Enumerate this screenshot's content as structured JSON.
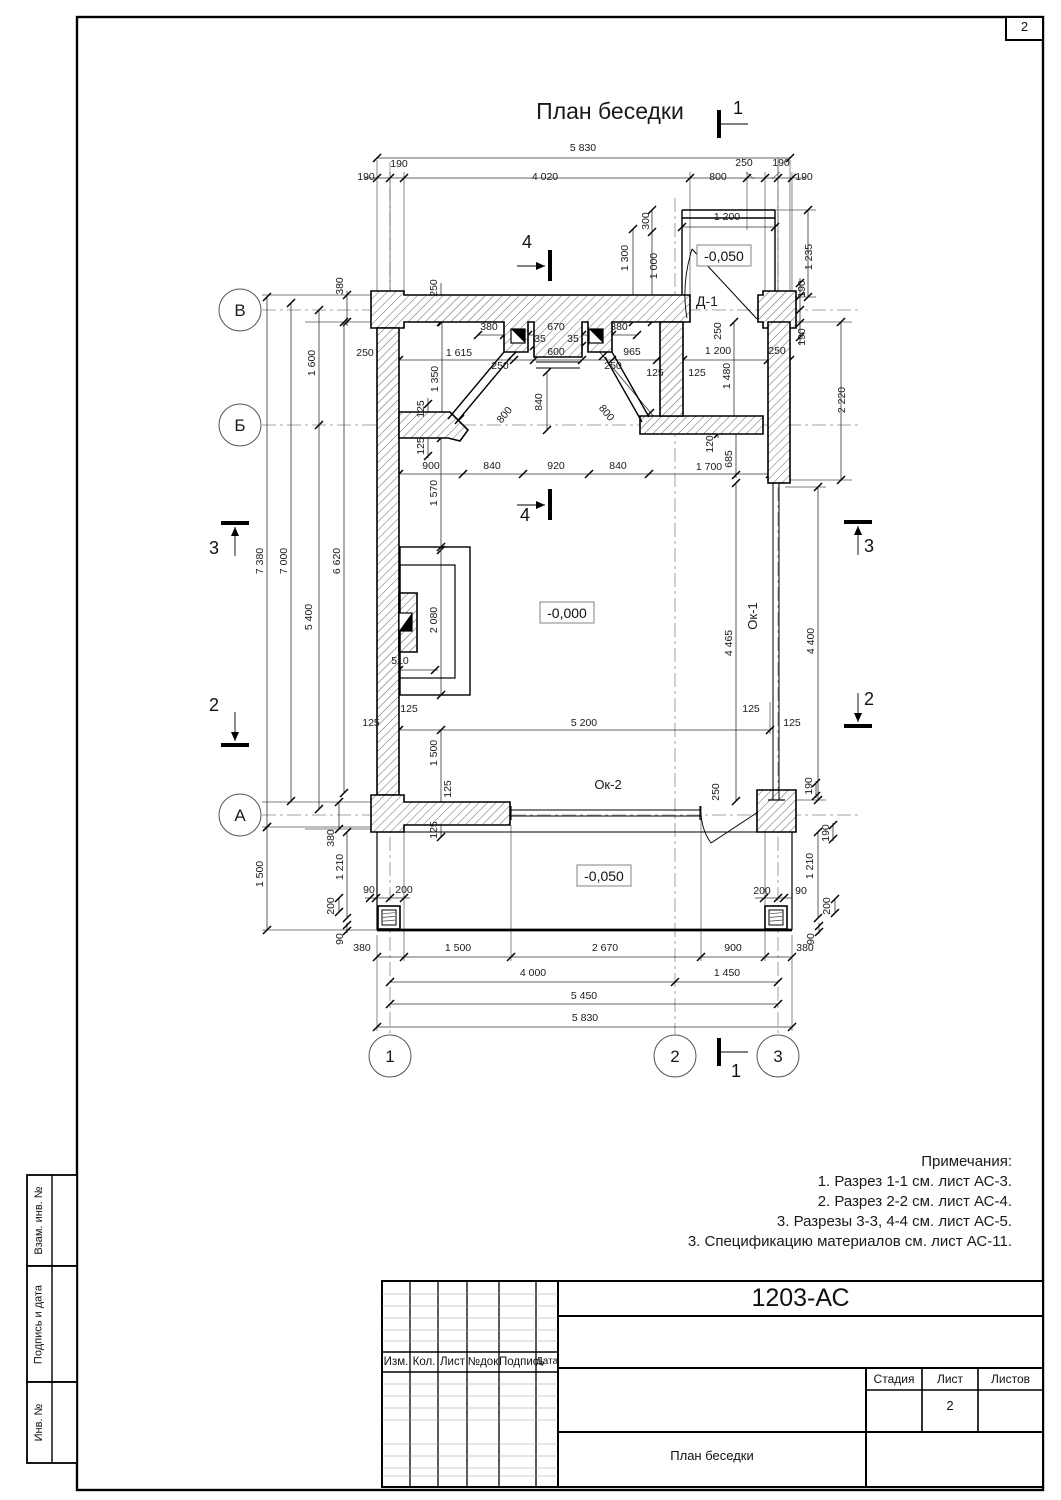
{
  "page": {
    "number": "2"
  },
  "title": "План беседки",
  "side_stamps": [
    "Взам. инв. №",
    "Подпись и дата",
    "Инв. №"
  ],
  "notes": {
    "heading": "Примечания:",
    "items": [
      "1. Разрез 1-1 см. лист АС-3.",
      "2. Разрез 2-2 см. лист АС-4.",
      "3. Разрезы 3-3, 4-4 см. лист АС-5.",
      "3. Спецификацию материалов см. лист АС-11."
    ]
  },
  "title_block": {
    "doc_number": "1203-АС",
    "columns": [
      "Изм.",
      "Кол.",
      "Лист",
      "№док",
      "Подпись",
      "Дата"
    ],
    "stage_label": "Стадия",
    "sheet_label": "Лист",
    "sheets_label": "Листов",
    "sheet_value": "2",
    "drawing_name": "План беседки"
  },
  "axis_markers": [
    {
      "t": "В",
      "x": 240,
      "y": 310
    },
    {
      "t": "Б",
      "x": 240,
      "y": 425
    },
    {
      "t": "А",
      "x": 240,
      "y": 815
    },
    {
      "t": "1",
      "x": 390,
      "y": 1056
    },
    {
      "t": "2",
      "x": 675,
      "y": 1056
    },
    {
      "t": "3",
      "x": 778,
      "y": 1056
    }
  ],
  "section_labels": [
    {
      "t": "1",
      "x": 738,
      "y": 114
    },
    {
      "t": "1",
      "x": 736,
      "y": 1077
    },
    {
      "t": "4",
      "x": 527,
      "y": 248
    },
    {
      "t": "4",
      "x": 525,
      "y": 521
    },
    {
      "t": "3",
      "x": 214,
      "y": 554
    },
    {
      "t": "2",
      "x": 214,
      "y": 711
    },
    {
      "t": "3",
      "x": 869,
      "y": 552
    },
    {
      "t": "2",
      "x": 869,
      "y": 705
    }
  ],
  "elevations": [
    {
      "t": "-0,050",
      "x": 724,
      "y": 257
    },
    {
      "t": "-0,000",
      "x": 567,
      "y": 614
    },
    {
      "t": "-0,050",
      "x": 604,
      "y": 877
    }
  ],
  "dims": [
    {
      "t": "5 830",
      "x": 583,
      "y": 151
    },
    {
      "t": "190",
      "x": 399,
      "y": 167
    },
    {
      "t": "190",
      "x": 366,
      "y": 180
    },
    {
      "t": "4 020",
      "x": 545,
      "y": 180
    },
    {
      "t": "800",
      "x": 718,
      "y": 180
    },
    {
      "t": "250",
      "x": 744,
      "y": 166
    },
    {
      "t": "190",
      "x": 781,
      "y": 166
    },
    {
      "t": "190",
      "x": 804,
      "y": 180
    },
    {
      "t": "1 200",
      "x": 727,
      "y": 220
    },
    {
      "t": "300",
      "x": 649,
      "y": 221,
      "r": -90
    },
    {
      "t": "1 300",
      "x": 628,
      "y": 258,
      "r": -90
    },
    {
      "t": "1 000",
      "x": 657,
      "y": 266,
      "r": -90
    },
    {
      "t": "1 235",
      "x": 812,
      "y": 257,
      "r": -90
    },
    {
      "t": "190",
      "x": 805,
      "y": 289,
      "r": -90
    },
    {
      "t": "190",
      "x": 805,
      "y": 337,
      "r": -90
    },
    {
      "t": "Д-1",
      "x": 707,
      "y": 306,
      "s": 14
    },
    {
      "t": "250",
      "x": 721,
      "y": 331,
      "r": -90
    },
    {
      "t": "1 200",
      "x": 718,
      "y": 354
    },
    {
      "t": "250",
      "x": 777,
      "y": 354
    },
    {
      "t": "1 480",
      "x": 730,
      "y": 376,
      "r": -90
    },
    {
      "t": "380",
      "x": 343,
      "y": 286,
      "r": -90
    },
    {
      "t": "250",
      "x": 437,
      "y": 288,
      "r": -90
    },
    {
      "t": "1 600",
      "x": 315,
      "y": 363,
      "r": -90
    },
    {
      "t": "250",
      "x": 365,
      "y": 356
    },
    {
      "t": "1 615",
      "x": 459,
      "y": 356
    },
    {
      "t": "1 350",
      "x": 438,
      "y": 379,
      "r": -90
    },
    {
      "t": "125",
      "x": 424,
      "y": 409,
      "r": -90
    },
    {
      "t": "125",
      "x": 424,
      "y": 446,
      "r": -90
    },
    {
      "t": "800",
      "x": 507,
      "y": 417,
      "r": -50
    },
    {
      "t": "800",
      "x": 604,
      "y": 415,
      "r": 50
    },
    {
      "t": "840",
      "x": 542,
      "y": 402,
      "r": -90
    },
    {
      "t": "380",
      "x": 489,
      "y": 330
    },
    {
      "t": "670",
      "x": 556,
      "y": 330
    },
    {
      "t": "380",
      "x": 619,
      "y": 330
    },
    {
      "t": "35",
      "x": 540,
      "y": 342
    },
    {
      "t": "35",
      "x": 573,
      "y": 342
    },
    {
      "t": "600",
      "x": 556,
      "y": 355
    },
    {
      "t": "965",
      "x": 632,
      "y": 355
    },
    {
      "t": "250",
      "x": 500,
      "y": 369
    },
    {
      "t": "250",
      "x": 613,
      "y": 369
    },
    {
      "t": "125",
      "x": 655,
      "y": 376
    },
    {
      "t": "125",
      "x": 697,
      "y": 376
    },
    {
      "t": "900",
      "x": 431,
      "y": 469
    },
    {
      "t": "840",
      "x": 492,
      "y": 469
    },
    {
      "t": "920",
      "x": 556,
      "y": 469
    },
    {
      "t": "840",
      "x": 618,
      "y": 469
    },
    {
      "t": "1 700",
      "x": 709,
      "y": 470
    },
    {
      "t": "1 570",
      "x": 437,
      "y": 493,
      "r": -90
    },
    {
      "t": "120",
      "x": 713,
      "y": 444,
      "r": -90
    },
    {
      "t": "685",
      "x": 732,
      "y": 459,
      "r": -90
    },
    {
      "t": "2 220",
      "x": 845,
      "y": 400,
      "r": -90
    },
    {
      "t": "7 380",
      "x": 263,
      "y": 561,
      "r": -90
    },
    {
      "t": "7 000",
      "x": 287,
      "y": 561,
      "r": -90
    },
    {
      "t": "6 620",
      "x": 340,
      "y": 561,
      "r": -90
    },
    {
      "t": "5 400",
      "x": 312,
      "y": 617,
      "r": -90
    },
    {
      "t": "2 080",
      "x": 437,
      "y": 620,
      "r": -90
    },
    {
      "t": "510",
      "x": 400,
      "y": 664
    },
    {
      "t": "125",
      "x": 409,
      "y": 712
    },
    {
      "t": "125",
      "x": 371,
      "y": 726
    },
    {
      "t": "5 200",
      "x": 584,
      "y": 726
    },
    {
      "t": "1 500",
      "x": 437,
      "y": 753,
      "r": -90
    },
    {
      "t": "4 465",
      "x": 732,
      "y": 643,
      "r": -90
    },
    {
      "t": "4 400",
      "x": 814,
      "y": 641,
      "r": -90
    },
    {
      "t": "Ок-1",
      "x": 757,
      "y": 616,
      "r": -90,
      "s": 13
    },
    {
      "t": "125",
      "x": 751,
      "y": 712
    },
    {
      "t": "125",
      "x": 792,
      "y": 726
    },
    {
      "t": "Ок-2",
      "x": 608,
      "y": 789,
      "s": 13
    },
    {
      "t": "250",
      "x": 719,
      "y": 792,
      "r": -90
    },
    {
      "t": "190",
      "x": 812,
      "y": 786,
      "r": -90
    },
    {
      "t": "190",
      "x": 829,
      "y": 833,
      "r": -90
    },
    {
      "t": "1 210",
      "x": 813,
      "y": 866,
      "r": -90
    },
    {
      "t": "200",
      "x": 762,
      "y": 894
    },
    {
      "t": "90",
      "x": 801,
      "y": 894
    },
    {
      "t": "200",
      "x": 830,
      "y": 906,
      "r": -90
    },
    {
      "t": "90",
      "x": 814,
      "y": 939,
      "r": -90
    },
    {
      "t": "1 500",
      "x": 263,
      "y": 874,
      "r": -90
    },
    {
      "t": "380",
      "x": 334,
      "y": 838,
      "r": -90
    },
    {
      "t": "1 210",
      "x": 343,
      "y": 867,
      "r": -90
    },
    {
      "t": "200",
      "x": 334,
      "y": 906,
      "r": -90
    },
    {
      "t": "90",
      "x": 369,
      "y": 893
    },
    {
      "t": "200",
      "x": 404,
      "y": 893
    },
    {
      "t": "90",
      "x": 343,
      "y": 939,
      "r": -90
    },
    {
      "t": "125",
      "x": 451,
      "y": 789,
      "r": -90
    },
    {
      "t": "125",
      "x": 437,
      "y": 830,
      "r": -90
    },
    {
      "t": "380",
      "x": 362,
      "y": 951
    },
    {
      "t": "1 500",
      "x": 458,
      "y": 951
    },
    {
      "t": "2 670",
      "x": 605,
      "y": 951
    },
    {
      "t": "900",
      "x": 733,
      "y": 951
    },
    {
      "t": "380",
      "x": 805,
      "y": 951
    },
    {
      "t": "4 000",
      "x": 533,
      "y": 976
    },
    {
      "t": "1 450",
      "x": 727,
      "y": 976
    },
    {
      "t": "5 450",
      "x": 584,
      "y": 999
    },
    {
      "t": "5 830",
      "x": 585,
      "y": 1021
    }
  ]
}
